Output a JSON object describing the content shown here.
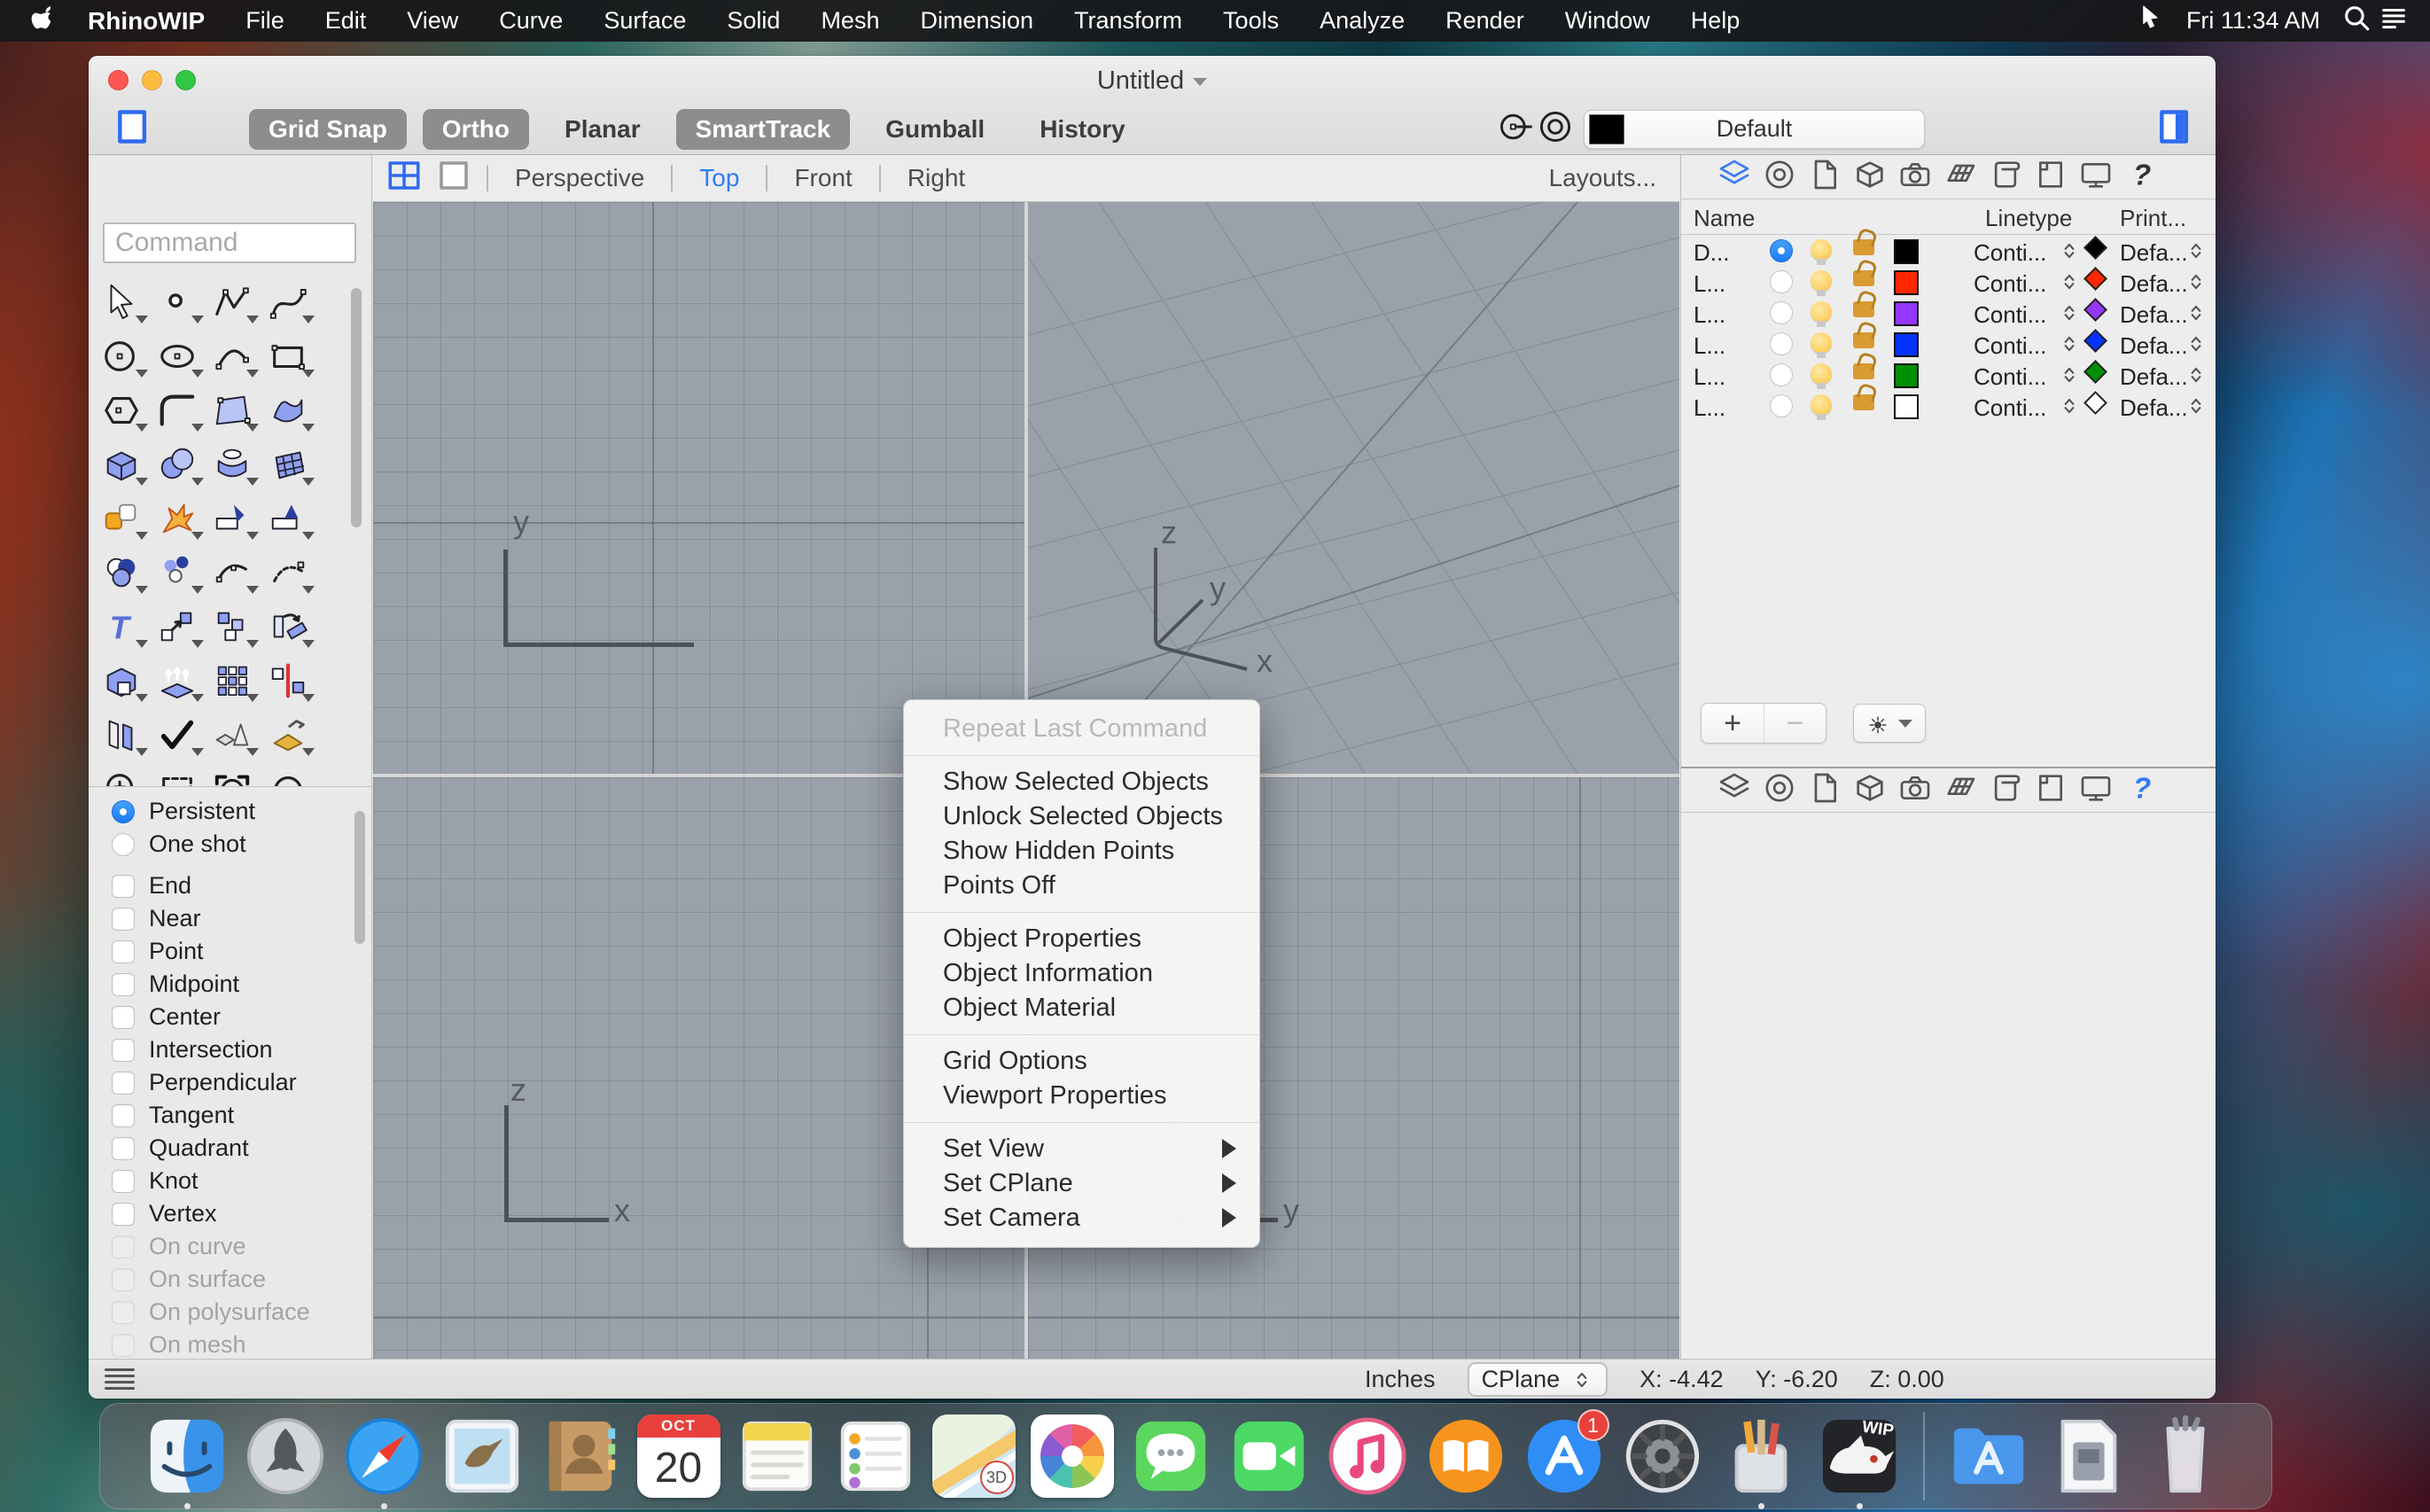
{
  "menubar": {
    "items": [
      "RhinoWIP",
      "File",
      "Edit",
      "View",
      "Curve",
      "Surface",
      "Solid",
      "Mesh",
      "Dimension",
      "Transform",
      "Tools",
      "Analyze",
      "Render",
      "Window",
      "Help"
    ],
    "clock": "Fri 11:34 AM",
    "icons": [
      "apple",
      "pointer",
      "spotlight-search",
      "notification-center"
    ]
  },
  "win": {
    "title": "Untitled",
    "toolbar": {
      "buttons": [
        {
          "label": "Grid Snap",
          "active": true
        },
        {
          "label": "Ortho",
          "active": true
        },
        {
          "label": "Planar",
          "active": false
        },
        {
          "label": "SmartTrack",
          "active": true
        },
        {
          "label": "Gumball",
          "active": false
        },
        {
          "label": "History",
          "active": false
        }
      ],
      "layer_dropdown": {
        "label": "Default",
        "swatch": "#000000"
      },
      "icons": [
        "left-panel-toggle",
        "osnap-point",
        "concentric-circles",
        "right-panel-toggle"
      ]
    },
    "viewport_tabs": {
      "tabs": [
        "Perspective",
        "Top",
        "Front",
        "Right"
      ],
      "active": "Top",
      "layouts_label": "Layouts...",
      "icons": [
        "four-pane-grid",
        "single-pane"
      ]
    },
    "viewports": {
      "background": "#9aa1aa",
      "top": {
        "y_label": "y"
      },
      "perspective": {
        "z_label": "z",
        "y_label": "y",
        "x_label": "x"
      },
      "front": {
        "z_label": "z",
        "x_label": "x"
      },
      "right": {
        "z_label": "z",
        "y_label": "y"
      }
    },
    "context_menu": {
      "items": [
        {
          "label": "Repeat Last Command",
          "disabled": true,
          "submenu": false
        },
        {
          "label": "Show Selected Objects",
          "disabled": false,
          "submenu": false
        },
        {
          "label": "Unlock Selected Objects",
          "disabled": false,
          "submenu": false
        },
        {
          "label": "Show Hidden Points",
          "disabled": false,
          "submenu": false
        },
        {
          "label": "Points Off",
          "disabled": false,
          "submenu": false
        },
        {
          "label": "Object Properties",
          "disabled": false,
          "submenu": false
        },
        {
          "label": "Object Information",
          "disabled": false,
          "submenu": false
        },
        {
          "label": "Object Material",
          "disabled": false,
          "submenu": false
        },
        {
          "label": "Grid Options",
          "disabled": false,
          "submenu": false
        },
        {
          "label": "Viewport Properties",
          "disabled": false,
          "submenu": false
        },
        {
          "label": "Set View",
          "disabled": false,
          "submenu": true
        },
        {
          "label": "Set CPlane",
          "disabled": false,
          "submenu": true
        },
        {
          "label": "Set Camera",
          "disabled": false,
          "submenu": true
        }
      ]
    },
    "sidebar": {
      "command_placeholder": "Command",
      "persistence": [
        {
          "label": "Persistent",
          "selected": true
        },
        {
          "label": "One shot",
          "selected": false
        }
      ],
      "osnaps": [
        {
          "label": "End",
          "disabled": false
        },
        {
          "label": "Near",
          "disabled": false
        },
        {
          "label": "Point",
          "disabled": false
        },
        {
          "label": "Midpoint",
          "disabled": false
        },
        {
          "label": "Center",
          "disabled": false
        },
        {
          "label": "Intersection",
          "disabled": false
        },
        {
          "label": "Perpendicular",
          "disabled": false
        },
        {
          "label": "Tangent",
          "disabled": false
        },
        {
          "label": "Quadrant",
          "disabled": false
        },
        {
          "label": "Knot",
          "disabled": false
        },
        {
          "label": "Vertex",
          "disabled": false
        },
        {
          "label": "On curve",
          "disabled": true
        },
        {
          "label": "On surface",
          "disabled": true
        },
        {
          "label": "On polysurface",
          "disabled": true
        },
        {
          "label": "On mesh",
          "disabled": true
        }
      ],
      "tool_icons": [
        "select",
        "point",
        "polyline",
        "curve",
        "circle",
        "ellipse",
        "arc",
        "rectangle",
        "polygon",
        "fillet",
        "surface-points",
        "surface-sweep",
        "box",
        "sphere",
        "revolve",
        "surface-patch",
        "plugins",
        "explode",
        "trim",
        "split",
        "boolean",
        "point-cloud",
        "blend",
        "rebuild",
        "text",
        "move",
        "copy",
        "rotate",
        "solid-edit",
        "extrude",
        "array",
        "mirror",
        "offset",
        "analyze-check",
        "primitives",
        "orient",
        "zoom",
        "dashed-select",
        "view-capture",
        "circle-tool"
      ]
    },
    "layers": {
      "columns": [
        "Name",
        "Linetype",
        "Print..."
      ],
      "rows": [
        {
          "name": "D...",
          "current": true,
          "color": "#000000",
          "linetype": "Conti...",
          "print": "Defa..."
        },
        {
          "name": "L...",
          "current": false,
          "color": "#ff2600",
          "linetype": "Conti...",
          "print": "Defa..."
        },
        {
          "name": "L...",
          "current": false,
          "color": "#9437ff",
          "linetype": "Conti...",
          "print": "Defa..."
        },
        {
          "name": "L...",
          "current": false,
          "color": "#0433ff",
          "linetype": "Conti...",
          "print": "Defa..."
        },
        {
          "name": "L...",
          "current": false,
          "color": "#008f00",
          "linetype": "Conti...",
          "print": "Defa..."
        },
        {
          "name": "L...",
          "current": false,
          "color": "#ffffff",
          "linetype": "Conti...",
          "print": "Defa..."
        }
      ],
      "add_label": "+",
      "remove_label": "−",
      "panel_tabs": [
        "layers",
        "display",
        "document",
        "solids",
        "camera",
        "materials",
        "notes",
        "page",
        "monitor",
        "help"
      ]
    },
    "statusbar": {
      "units": "Inches",
      "cplane": "CPlane",
      "x": "X: -4.42",
      "y": "Y: -6.20",
      "z": "Z: 0.00"
    }
  },
  "dock": {
    "icons": [
      "finder",
      "launchpad",
      "safari",
      "mail",
      "contacts",
      "calendar",
      "notes",
      "reminders",
      "maps",
      "photos",
      "messages",
      "facetime",
      "music",
      "books",
      "app-store",
      "system-preferences",
      "design-tools",
      "rhino-wip",
      "applications-folder",
      "disk-image",
      "trash"
    ],
    "calendar": {
      "month": "OCT",
      "day": "20"
    },
    "appstore_badge": "1",
    "maps_label": "3D",
    "wip_label": "WIP"
  }
}
